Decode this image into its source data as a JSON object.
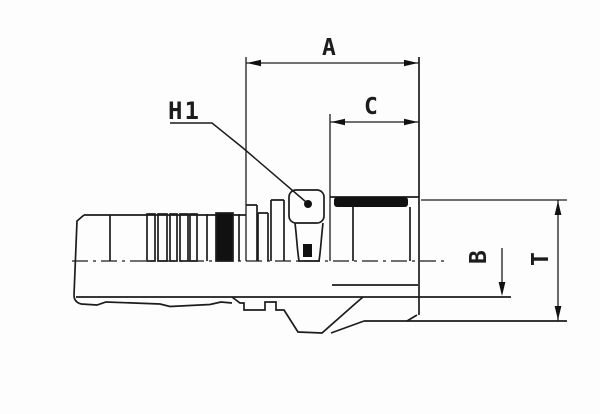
{
  "drawing": {
    "type": "technical-dimension-drawing",
    "subject": "hydraulic hose insert fitting, side view with hose tail, hex nut and male thread",
    "labels": {
      "a": "A",
      "c": "C",
      "h1": "H1",
      "b": "B",
      "t": "T"
    }
  },
  "colors": {
    "line": "#1c1c1c",
    "fill": "#111111",
    "background": "#fdfdfd"
  }
}
